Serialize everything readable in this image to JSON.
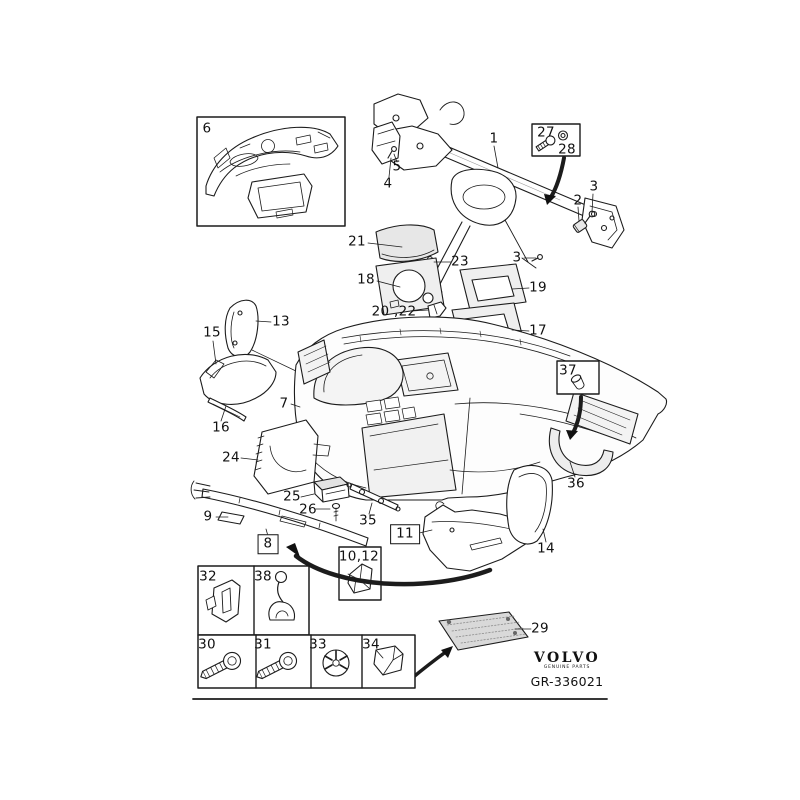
{
  "figure": {
    "type": "exploded-parts-diagram",
    "subject": "dashboard / instrument panel assembly",
    "drawing_code": "GR-336021"
  },
  "brand": {
    "name": "VOLVO",
    "tagline": "GENUINE PARTS"
  },
  "callouts": [
    {
      "label": "6",
      "x": 207,
      "y": 129,
      "boxed": false
    },
    {
      "label": "4",
      "x": 388,
      "y": 184,
      "boxed": false
    },
    {
      "label": "5",
      "x": 397,
      "y": 167,
      "boxed": false
    },
    {
      "label": "1",
      "x": 494,
      "y": 139,
      "boxed": false
    },
    {
      "label": "27",
      "x": 546,
      "y": 133,
      "boxed": false
    },
    {
      "label": "28",
      "x": 567,
      "y": 150,
      "boxed": false
    },
    {
      "label": "2",
      "x": 578,
      "y": 201,
      "boxed": false
    },
    {
      "label": "3",
      "x": 594,
      "y": 187,
      "boxed": false
    },
    {
      "label": "3",
      "x": 517,
      "y": 258,
      "boxed": false
    },
    {
      "label": "21",
      "x": 357,
      "y": 242,
      "boxed": false
    },
    {
      "label": "23",
      "x": 460,
      "y": 262,
      "boxed": false
    },
    {
      "label": "18",
      "x": 366,
      "y": 280,
      "boxed": false
    },
    {
      "label": "19",
      "x": 538,
      "y": 288,
      "boxed": false
    },
    {
      "label": "20 ,22",
      "x": 394,
      "y": 312,
      "boxed": false
    },
    {
      "label": "17",
      "x": 538,
      "y": 331,
      "boxed": false
    },
    {
      "label": "13",
      "x": 281,
      "y": 322,
      "boxed": false
    },
    {
      "label": "15",
      "x": 212,
      "y": 333,
      "boxed": false
    },
    {
      "label": "37",
      "x": 568,
      "y": 371,
      "boxed": false
    },
    {
      "label": "7",
      "x": 284,
      "y": 404,
      "boxed": false
    },
    {
      "label": "16",
      "x": 221,
      "y": 428,
      "boxed": false
    },
    {
      "label": "24",
      "x": 231,
      "y": 458,
      "boxed": false
    },
    {
      "label": "36",
      "x": 576,
      "y": 484,
      "boxed": false
    },
    {
      "label": "25",
      "x": 292,
      "y": 497,
      "boxed": false
    },
    {
      "label": "26",
      "x": 308,
      "y": 510,
      "boxed": false
    },
    {
      "label": "9",
      "x": 208,
      "y": 517,
      "boxed": false
    },
    {
      "label": "35",
      "x": 368,
      "y": 521,
      "boxed": false
    },
    {
      "label": "8",
      "x": 268,
      "y": 544,
      "boxed": true
    },
    {
      "label": "11",
      "x": 405,
      "y": 534,
      "boxed": true
    },
    {
      "label": "10,12",
      "x": 359,
      "y": 557,
      "boxed": false
    },
    {
      "label": "14",
      "x": 546,
      "y": 549,
      "boxed": false
    },
    {
      "label": "29",
      "x": 540,
      "y": 629,
      "boxed": false
    },
    {
      "label": "32",
      "x": 208,
      "y": 577,
      "boxed": false
    },
    {
      "label": "38",
      "x": 263,
      "y": 577,
      "boxed": false
    },
    {
      "label": "30",
      "x": 207,
      "y": 645,
      "boxed": false
    },
    {
      "label": "31",
      "x": 263,
      "y": 645,
      "boxed": false
    },
    {
      "label": "33",
      "x": 318,
      "y": 645,
      "boxed": false
    },
    {
      "label": "34",
      "x": 371,
      "y": 645,
      "boxed": false
    }
  ]
}
